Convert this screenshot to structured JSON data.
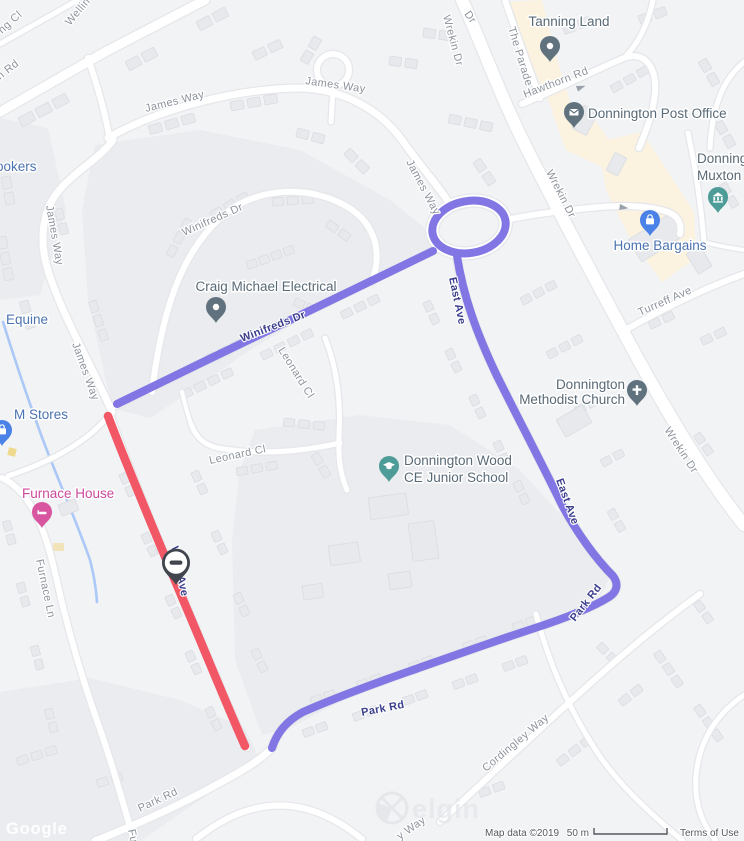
{
  "colors": {
    "background": "#f2f3f5",
    "area_shade": "#eaecef",
    "commercial_area": "#fbf2e0",
    "road_fill": "#ffffff",
    "road_casing": "#e5e7ea",
    "building_fill": "#e7e9ec",
    "building_stroke": "#dadce2",
    "water": "#abc8f7",
    "route_diversion": "#8176e3",
    "route_closure": "#f25766",
    "route_label": "#3b3f8c",
    "street_label": "#8d939d",
    "poi_slate": "#596a77",
    "poi_blue": "#4b73b1",
    "poi_pink": "#cb4a9c",
    "pin_slate": "#61727f",
    "pin_teal": "#4e9c97",
    "pin_blue": "#4b82e8",
    "pin_pink": "#d8569f",
    "pin_dark": "#41464e"
  },
  "street_labels": [
    {
      "t": "ng Cl",
      "x": 2,
      "y": 34,
      "r": -42
    },
    {
      "t": "n Rd",
      "x": 0,
      "y": 80,
      "r": -38
    },
    {
      "t": "Wellin",
      "x": 70,
      "y": 26,
      "r": -50
    },
    {
      "t": "James Way",
      "x": 146,
      "y": 112,
      "r": -14
    },
    {
      "t": "James Way",
      "x": 305,
      "y": 84,
      "r": 8
    },
    {
      "t": "James Way",
      "x": 406,
      "y": 162,
      "r": 62
    },
    {
      "t": "James Way",
      "x": 46,
      "y": 206,
      "r": 80
    },
    {
      "t": "James Way",
      "x": 72,
      "y": 344,
      "r": 70
    },
    {
      "t": "Dr",
      "x": 464,
      "y": 14,
      "r": 55
    },
    {
      "t": "Wrekin Dr",
      "x": 443,
      "y": 16,
      "r": 75
    },
    {
      "t": "The Parade",
      "x": 508,
      "y": 28,
      "r": 73
    },
    {
      "t": "Hawthorn Rd",
      "x": 525,
      "y": 98,
      "r": -21
    },
    {
      "t": "Wrekin Dr",
      "x": 546,
      "y": 172,
      "r": 63
    },
    {
      "t": "Turreff Ave",
      "x": 640,
      "y": 316,
      "r": -24
    },
    {
      "t": "Wrekin Dr",
      "x": 664,
      "y": 430,
      "r": 57
    },
    {
      "t": "Winifreds Dr",
      "x": 184,
      "y": 236,
      "r": -24
    },
    {
      "t": "Leonard Cl",
      "x": 278,
      "y": 350,
      "r": 58
    },
    {
      "t": "Leonard Cl",
      "x": 210,
      "y": 464,
      "r": -12
    },
    {
      "t": "Cordingley Way",
      "x": 486,
      "y": 772,
      "r": -40
    },
    {
      "t": "Furnace Ln",
      "x": 36,
      "y": 560,
      "r": 78
    },
    {
      "t": "Fu",
      "x": 128,
      "y": 830,
      "r": 78
    },
    {
      "t": "Park Rd",
      "x": 140,
      "y": 812,
      "r": -25
    },
    {
      "t": "y Way",
      "x": 400,
      "y": 840,
      "r": -35
    }
  ],
  "route_labels": [
    {
      "t": "Winifreds Dr",
      "x": 242,
      "y": 342,
      "r": -21
    },
    {
      "t": "East Ave",
      "x": 449,
      "y": 278,
      "r": 78
    },
    {
      "t": "East Ave",
      "x": 556,
      "y": 480,
      "r": 70
    },
    {
      "t": "Park Rd",
      "x": 575,
      "y": 622,
      "r": -52
    },
    {
      "t": "Park Rd",
      "x": 362,
      "y": 716,
      "r": -11
    },
    {
      "t": "West Ave",
      "x": 171,
      "y": 547,
      "r": 78
    }
  ],
  "pois": [
    {
      "id": "tanning-land",
      "lines": [
        "Tanning Land"
      ],
      "x": 569,
      "y": 26,
      "anchor": "middle",
      "style": "slate",
      "pin": {
        "x": 550,
        "y": 62,
        "glyph": "dot",
        "color": "slate"
      }
    },
    {
      "id": "donnington-post-office",
      "lines": [
        "Donnington Post Office"
      ],
      "x": 588,
      "y": 118,
      "anchor": "start",
      "style": "slate",
      "pin": {
        "x": 574,
        "y": 128,
        "glyph": "envelope",
        "color": "slate"
      }
    },
    {
      "id": "donnington-muxton",
      "lines": [
        "Donning",
        "Muxton"
      ],
      "x": 697,
      "y": 163,
      "lh": 17,
      "anchor": "start",
      "style": "slate",
      "pin": {
        "x": 718,
        "y": 213,
        "glyph": "bank",
        "color": "teal"
      }
    },
    {
      "id": "home-bargains",
      "lines": [
        "Home Bargains"
      ],
      "x": 660,
      "y": 250,
      "anchor": "middle",
      "style": "blue",
      "pin": {
        "x": 650,
        "y": 236,
        "glyph": "bag",
        "color": "blue"
      }
    },
    {
      "id": "donnington-methodist-church",
      "lines": [
        "Donnington",
        "Methodist Church"
      ],
      "x": 625,
      "y": 389,
      "lh": 15,
      "anchor": "end",
      "style": "slate",
      "pin": {
        "x": 637,
        "y": 406,
        "glyph": "cross",
        "color": "slate"
      }
    },
    {
      "id": "donnington-wood-ce-junior-school",
      "lines": [
        "Donnington Wood",
        "CE Junior School"
      ],
      "x": 404,
      "y": 465,
      "lh": 17,
      "anchor": "start",
      "style": "slate",
      "pin": {
        "x": 389,
        "y": 482,
        "glyph": "cap",
        "color": "teal"
      }
    },
    {
      "id": "craig-michael-electrical",
      "lines": [
        "Craig Michael Electrical"
      ],
      "x": 266,
      "y": 291,
      "anchor": "middle",
      "style": "slate",
      "pin": {
        "x": 216,
        "y": 323,
        "glyph": "dot",
        "color": "slate"
      }
    },
    {
      "id": "furnace-house",
      "lines": [
        "Furnace House"
      ],
      "x": 22,
      "y": 498,
      "anchor": "start",
      "style": "pink",
      "pin": {
        "x": 42,
        "y": 528,
        "glyph": "bed",
        "color": "pink"
      }
    },
    {
      "id": "ookers",
      "lines": [
        "ookers"
      ],
      "x": -4,
      "y": 171,
      "anchor": "start",
      "style": "blue"
    },
    {
      "id": "equine",
      "lines": [
        "Equine"
      ],
      "x": 6,
      "y": 324,
      "anchor": "start",
      "style": "blue"
    },
    {
      "id": "m-stores",
      "lines": [
        "M Stores"
      ],
      "x": 14,
      "y": 419,
      "anchor": "start",
      "style": "blue",
      "pin": {
        "x": 2,
        "y": 446,
        "glyph": "bag",
        "color": "blue"
      }
    }
  ],
  "no_entry_marker": {
    "x": 176,
    "y": 585
  },
  "watermarks": {
    "google": "Google",
    "elgin": "elgin"
  },
  "attribution": {
    "map_data": "Map data ©2019",
    "scale_text": "50 m",
    "terms": "Terms of Use"
  }
}
